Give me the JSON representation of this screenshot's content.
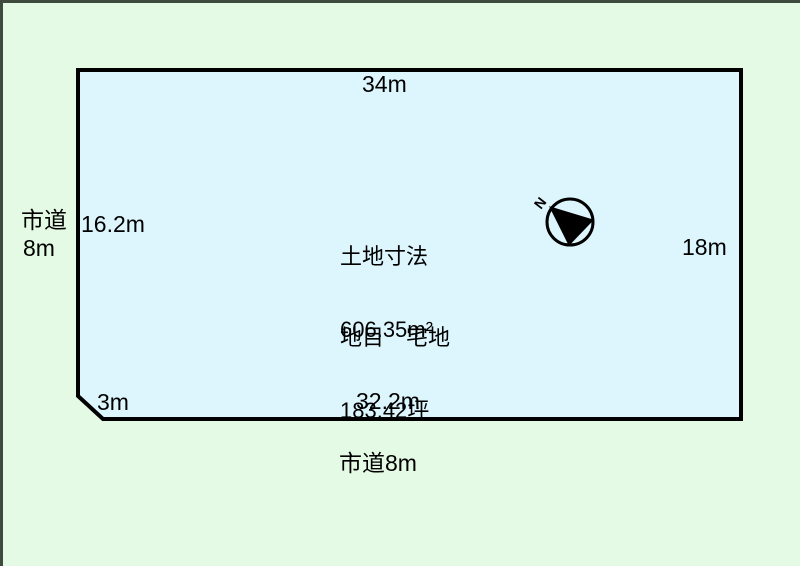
{
  "canvas": {
    "background_color": "#e4fae4",
    "frame_border_color": "#3f4a3f",
    "plot_fill_color": "#ddf6fd",
    "plot_outline_color": "#000000"
  },
  "plot": {
    "dimensions": {
      "top_edge": "34m",
      "left_edge": "16.2m",
      "right_edge": "18m",
      "chamfer_edge": "3m",
      "bottom_edge": "32.2m"
    },
    "roads": {
      "left_road_line1": "市道",
      "left_road_line2": "8m",
      "bottom_road": "市道8m"
    },
    "info": {
      "title": "土地寸法",
      "land_category": "地目　宅地",
      "area_m2": "606.35m²",
      "area_tsubo": "183.42坪"
    },
    "compass": {
      "north_label": "N"
    }
  }
}
